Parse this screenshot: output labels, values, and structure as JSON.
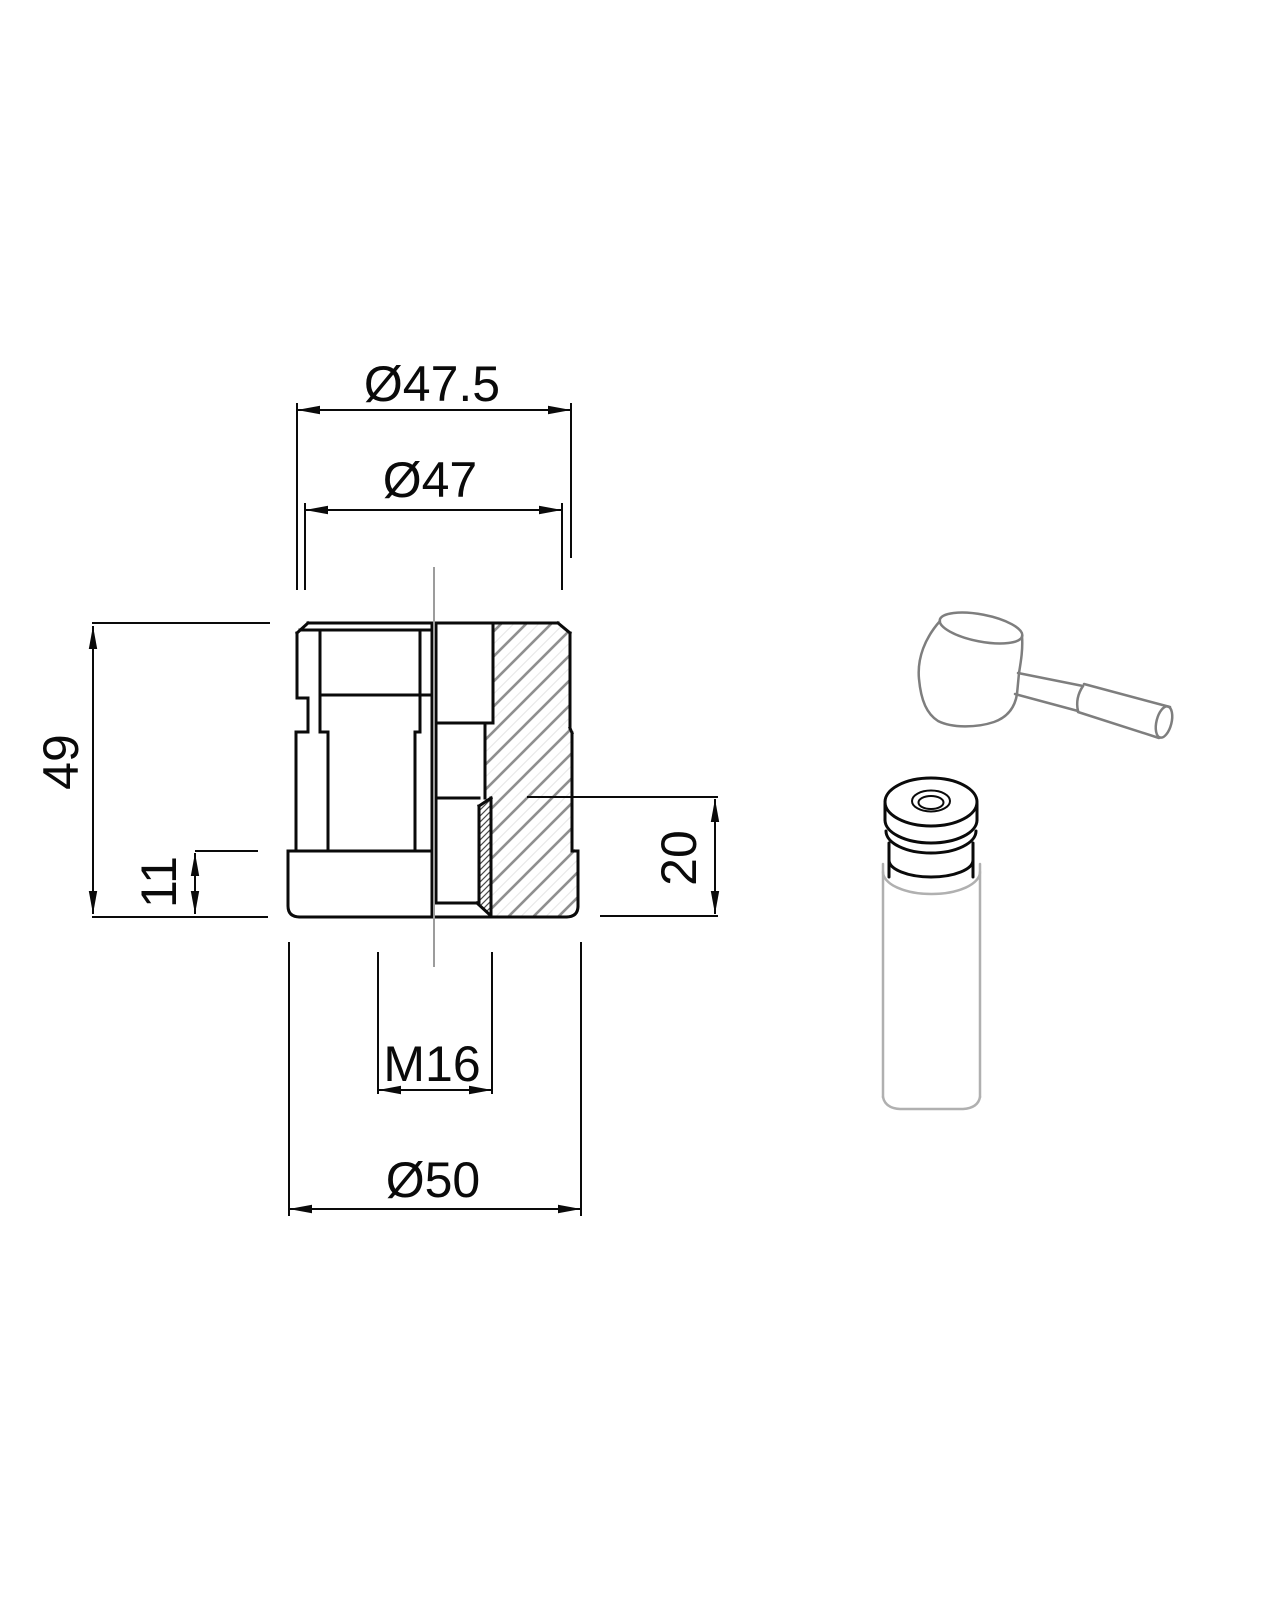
{
  "drawing": {
    "dims": {
      "d475": "Ø47.5",
      "d47": "Ø47",
      "h49": "49",
      "h11": "11",
      "t20": "20",
      "m16": "M16",
      "d50": "Ø50"
    },
    "colors": {
      "line": "#0a0a0a",
      "hatch": "#8f8f8f",
      "centerline": "#9c9c9c",
      "accessory": "#7e7e7e",
      "cylinder": "#b0b0b0",
      "background": "#ffffff"
    }
  }
}
